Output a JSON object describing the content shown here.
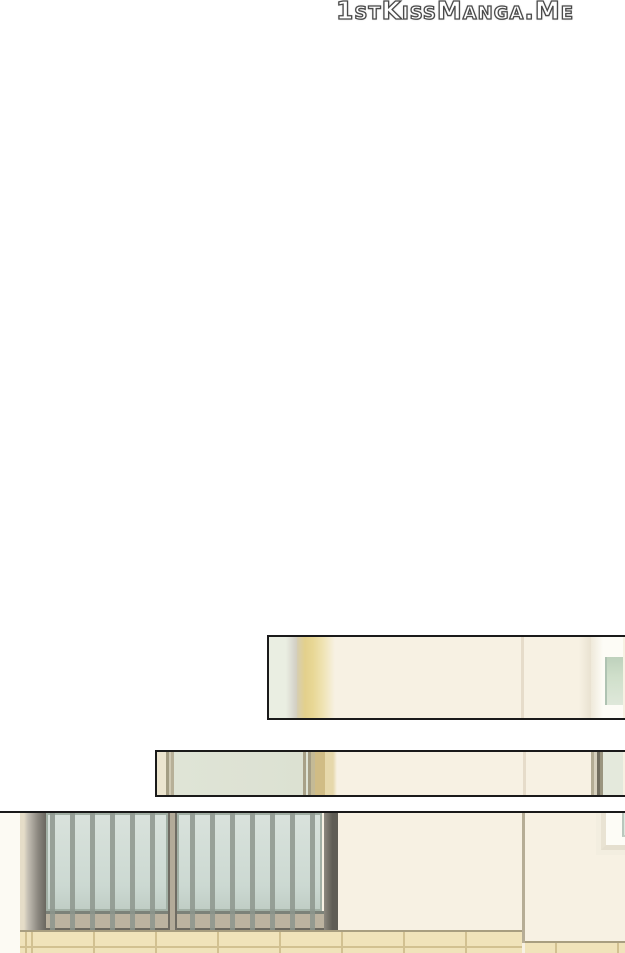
{
  "page": {
    "watermark": "1stKissManga.Me"
  },
  "palette": {
    "page-bg": "#ffffff",
    "panel-border": "#1a1a1a",
    "wall-cream": "#f7f1e3",
    "glass-green-pale": "#eaeee2",
    "glass-green": "#dfe4d6",
    "glass-blue": "#ccd9d2",
    "glass-blue-light": "#d9e2dc",
    "khaki-stripe": "#e3d08c",
    "khaki-light": "#efe3b3",
    "olive-line": "#a49d83",
    "faint-line": "#e6dcca",
    "tan-line": "#b6ad96",
    "bar-gray": "#8d968d",
    "post-gray": "#8a867e",
    "post-dark": "#5f5d55",
    "rail-tan": "#bcb3a0",
    "rail-dark": "#6b685f",
    "tile-fill": "#f0e3ba",
    "tile-joint": "#d2c191",
    "tile-edge": "#a89e80",
    "frame-white": "#fdfcf6",
    "window-glass": "#cfdfca",
    "window-glass-dark": "#bed1bc",
    "watermark-outline": "#4a4a4a",
    "watermark-halo": "#b5b5b5"
  }
}
